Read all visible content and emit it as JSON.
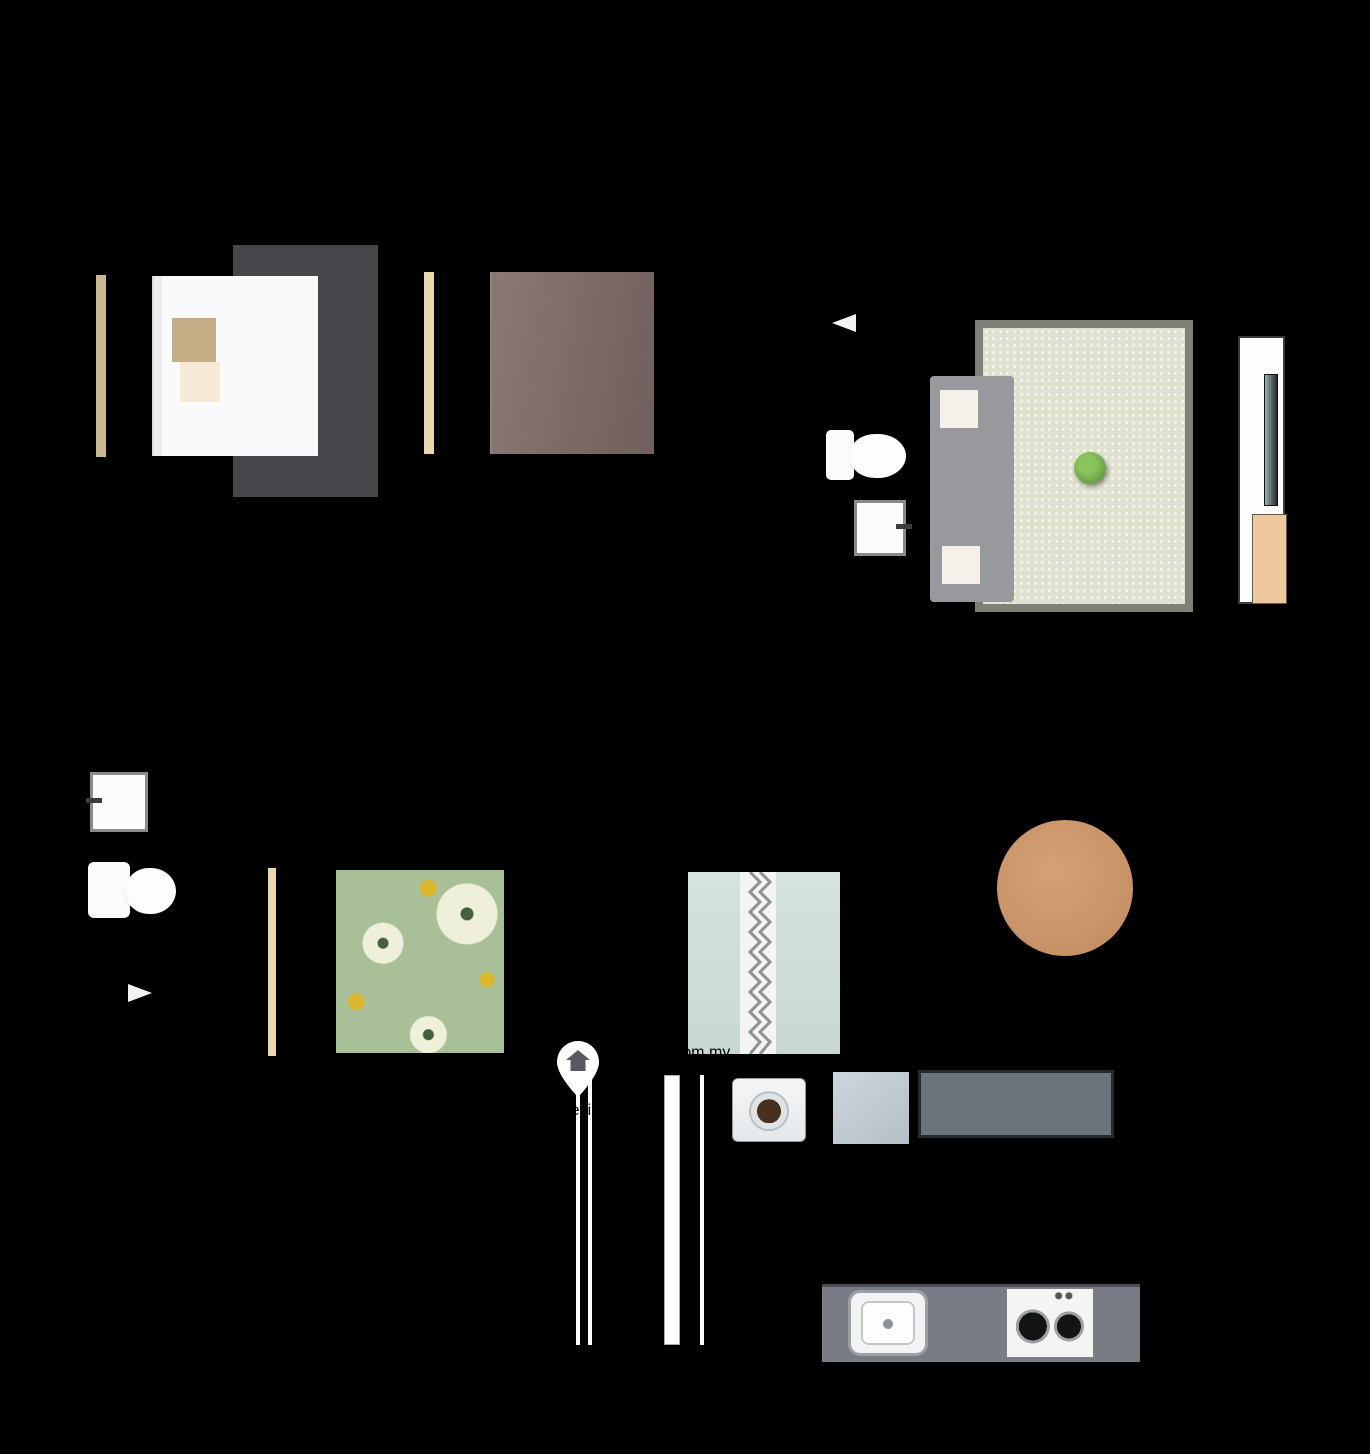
{
  "labels": {
    "balcony": "BALCONY",
    "ac_top": "A/C",
    "ac_bottom": "A/C"
  },
  "watermark": {
    "brand": "iProperty.com.my",
    "agent": "Kevin Lee",
    "pin_icon": "location-pin-house-icon"
  },
  "colors": {
    "background": "#000000",
    "wall": "#0e0e0e",
    "floor_bedroom": "#d2a37f",
    "floor_living": "#efe8d5",
    "floor_bathroom": "#aaa395",
    "floor_balcony": "#d6d4cd",
    "floor_yard": "#d4d2c5",
    "rug_bedroom1": "#47474b",
    "rug_living": "#e0e2d0",
    "duvet_bedroom2": "#7d6b69",
    "duvet_bedroom3": "#a9bf98",
    "duvet_bedroom4": "#cfdeda",
    "dining_table": "#c8946a",
    "counter": "#787c83",
    "accent_tan": "#eec9a0",
    "watermark_text": "#ffffff",
    "overlay": "#7a828e"
  }
}
